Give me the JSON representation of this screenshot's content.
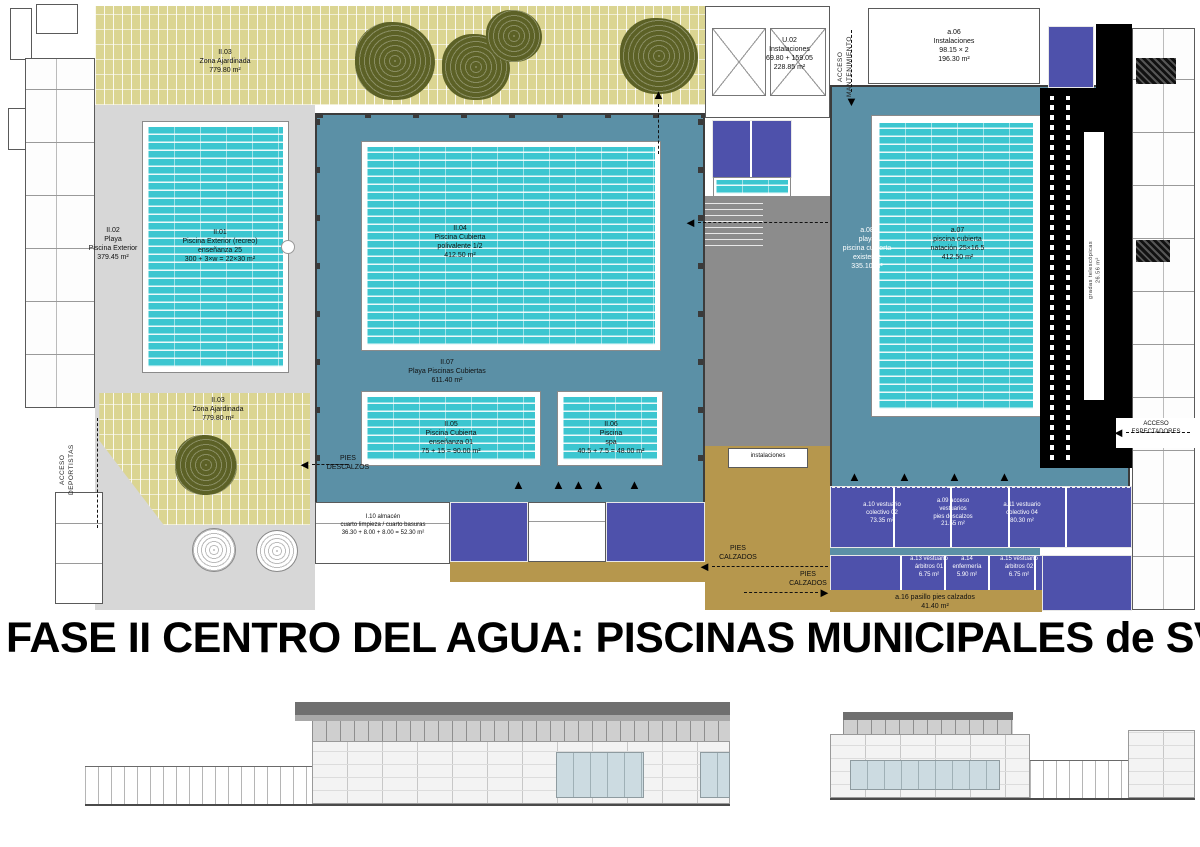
{
  "title": "FASE II CENTRO DEL AGUA: PISCINAS MUNICIPALES de SVdR",
  "colors": {
    "pool_cyan": "#3cc6d0",
    "deck_blue": "#5b90a6",
    "vestuarios_indigo": "#4e51ab",
    "pies_calzados_tan": "#b6974d",
    "garden_khaki": "#dbd592",
    "tree_olive": "#5c6126",
    "plaza_grey": "#d7d7d7",
    "corridor_grey": "#8c8c8c",
    "bleachers_black": "#000000"
  },
  "labels": [
    {
      "name": "garden-top",
      "text": "II.03\nZona Ajardinada\n779.80 m²"
    },
    {
      "name": "playa-exterior",
      "text": "II.02\nPlaya\nPiscina Exterior\n379.45 m²"
    },
    {
      "name": "piscina-exterior",
      "text": "II.01\nPiscina Exterior (recreo)\nenseñanza 25\n300 + 3×w = 22×30 m²"
    },
    {
      "name": "piscina-cubierta",
      "text": "II.04\nPiscina Cubierta\npolivalente 1/2\n412.50 m²"
    },
    {
      "name": "playa-cubiertas",
      "text": "II.07\nPlaya Piscinas Cubiertas\n611.40 m²"
    },
    {
      "name": "piscina-ensenanza",
      "text": "II.05\nPiscina Cubierta\nenseñanza 01\n75 + 15 = 90.00 m²"
    },
    {
      "name": "piscina-spa",
      "text": "II.06\nPiscina\nspa\n40.5 + 7.5 = 48.00 m²"
    },
    {
      "name": "garden-bottom",
      "text": "II.03\nZona Ajardinada\n779.80 m²"
    },
    {
      "name": "almacen",
      "text": "I.10 almacén\ncuarto limpieza / cuarto basuras\n36.30 + 8.00 + 8.00 = 52.30 m²"
    },
    {
      "name": "instalaciones-u02",
      "text": "U.02\nInstalaciones\n69.80 + 159.05\n228.85 m²"
    },
    {
      "name": "instalaciones-a06",
      "text": "a.06\nInstalaciones\n98.15 × 2\n196.30 m²"
    },
    {
      "name": "playa-cubierta-a08",
      "text": "a.08\nplaya\npiscina cubierta\nexistente\n335.10 m²"
    },
    {
      "name": "piscina-natacion",
      "text": "a.07\npiscina cubierta\nnatación 25×16.5\n412.50 m²"
    },
    {
      "name": "instalaciones-box",
      "text": "instalaciones"
    },
    {
      "name": "pies-descalzos",
      "text": "PIES\nDESCALZOS"
    },
    {
      "name": "pies-calzados-1",
      "text": "PIES\nCALZADOS"
    },
    {
      "name": "pies-calzados-2",
      "text": "PIES\nCALZADOS"
    },
    {
      "name": "vestuario-a10",
      "text": "a.10 vestuario\ncolectivo 02\n73.35 m²"
    },
    {
      "name": "acceso-vestuarios",
      "text": "a.09 acceso\nvestuarios\npies descalzos\n21.55 m²"
    },
    {
      "name": "vestuario-a11",
      "text": "a.11 vestuario\ncolectivo 04\n80.30 m²"
    },
    {
      "name": "vestuario-arbitros-1",
      "text": "a.13 vestuario\nárbitros 01\n6.75 m²"
    },
    {
      "name": "enfermeria",
      "text": "a.14\nenfermería\n5.90 m²"
    },
    {
      "name": "vestuario-arbitros-2",
      "text": "a.15 vestuario\nárbitros 02\n6.75 m²"
    },
    {
      "name": "pasillo-calzados",
      "text": "a.16 pasillo pies calzados\n41.40 m²"
    },
    {
      "name": "acceso-deportistas",
      "text": "ACCESO\nDEPORTISTAS"
    },
    {
      "name": "acceso-mantenimiento",
      "text": "ACCESO\nMANTENIMIENTO"
    },
    {
      "name": "acceso-espectadores",
      "text": "ACCESO\nESPECTADORES"
    },
    {
      "name": "gradas",
      "text": "gradas telescópicas\n26.56 m²"
    }
  ]
}
